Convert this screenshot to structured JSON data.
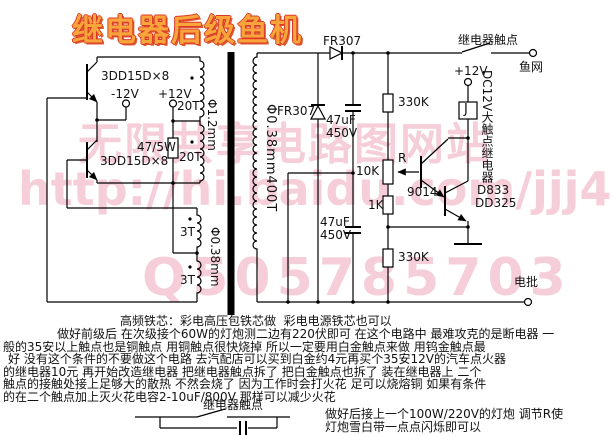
{
  "title": "继电器后级鱼机",
  "colors": {
    "title_fill": "#faa43c",
    "title_outline": "#d93a28",
    "watermark_pink": "#eda7bb",
    "wire": "#000000"
  },
  "watermarks": {
    "site": "无限共享电路图网站",
    "url": "http://hi.baidu.com/jjj4",
    "qq": "Q505785703"
  },
  "labels": {
    "q1": "3DD15D×8",
    "q2": "3DD15D×8",
    "neg12": "-12V",
    "pos12_left": "+12V",
    "pos12_right": "+12V",
    "r47": "47/5W",
    "t20_a": "20T",
    "t20_b": "20T",
    "t3_a": "3T",
    "t3_b": "3T",
    "phi_primary": "Φ1.2mm",
    "phi_feedback": "Φ0.38mm",
    "phi_secondary": "Φ0.38mm400T",
    "d1": "FR307",
    "d2": "FR307",
    "c1": "47uF\n450V",
    "c2": "47uF\n450V",
    "r330_top": "330K",
    "r330_bottom": "330K",
    "pot_name": "R",
    "pot_value": "10K",
    "r1k": "1K",
    "q3": "9014",
    "q4_line1": "D833",
    "q4_line2": "DD325",
    "relay": "J",
    "relay_desc": "DC12V大触点继电器",
    "contact_top": "继电器触点",
    "fishnet": "鱼网",
    "probe": "电批",
    "contact_bottom": "继电器触点"
  },
  "notes": {
    "l1": "高频铁芯：彩电高压包铁芯做  彩电电源铁芯也可以",
    "l2": "做好前级后 在次级接个60W的灯炮测二边有220伏即可 在这个电路中 最难攻克的是断电器 一",
    "l3": "般的35安以上触点也是铜触点 用铜触点很快烧掉 所以一定要用白金触点来做 用钨金触点最",
    "l4": "好 没有这个条件的不要做这个电路 去汽配店可以买到白金约4元再买个35安12V的汽车点火器",
    "l5": "的继电器10元 再开始改造继电器 把继电器触点拆了 把白金触点也拆了 装在继电器上 二个",
    "l6": "触点的接触处接上足够大的散热 不然会烧了 因为工作时会打火花 足可以烧熔铜 如果有条件",
    "l7": "的在二个触点加上灭火花电容2-10uF/800V 那样可以减少火花",
    "r1": "做好后接上一个100W/220V的灯炮 调节R使",
    "r2": "灯炮雪白带一点点闪烁即可以"
  }
}
